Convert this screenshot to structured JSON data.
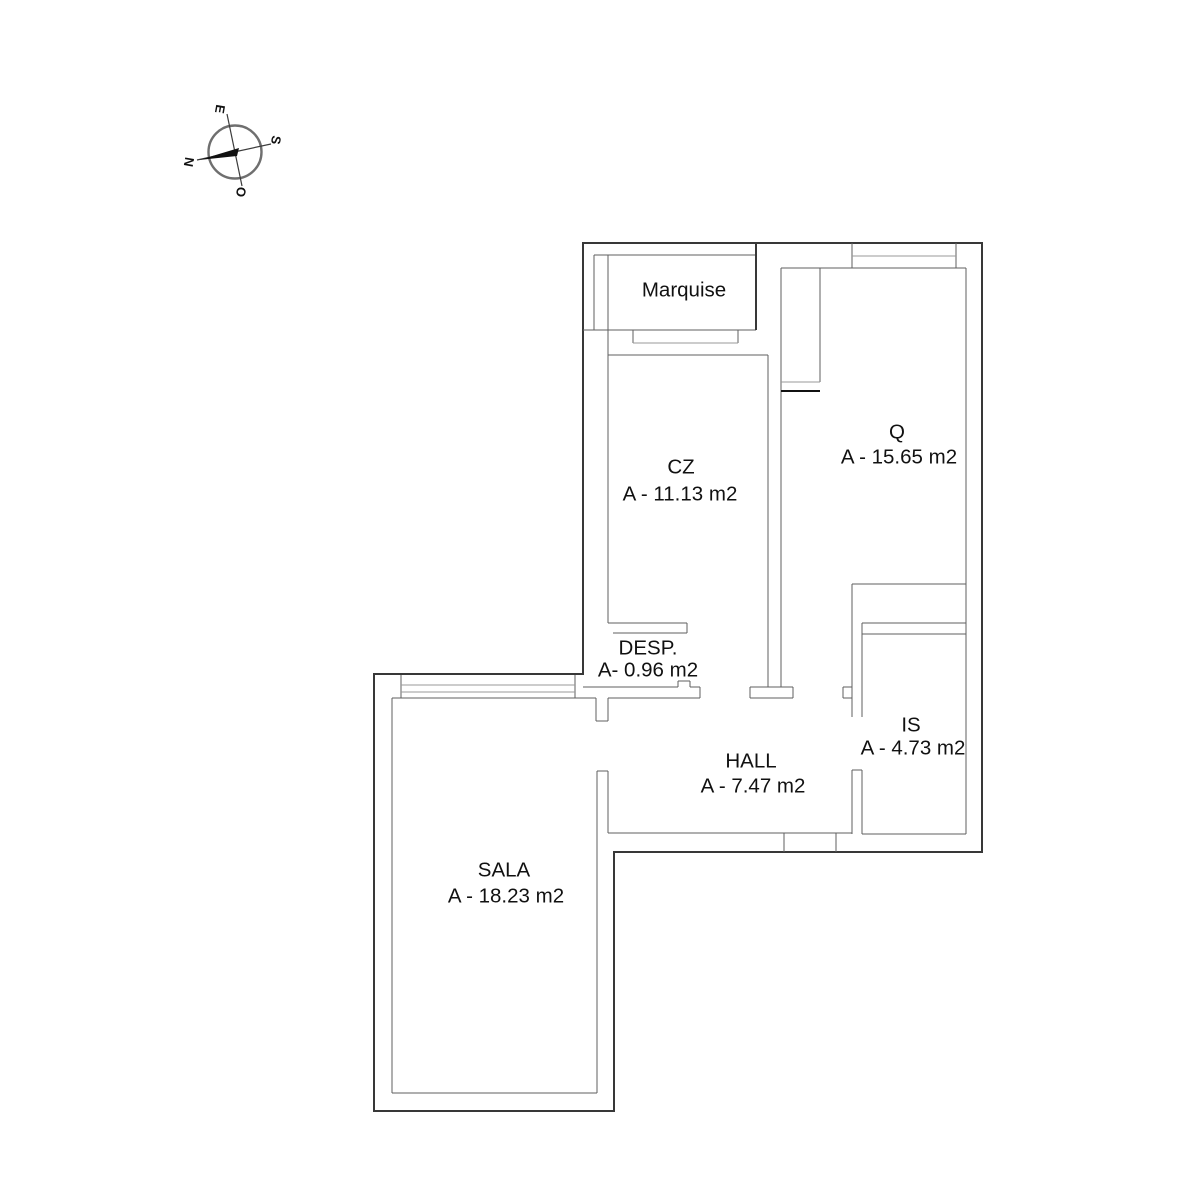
{
  "document": {
    "type": "floor-plan drawing",
    "background": "#ffffff"
  },
  "compass": {
    "north": "N",
    "south": "S",
    "east": "E",
    "west": "O"
  },
  "rooms": {
    "marquise": {
      "name": "Marquise",
      "area": ""
    },
    "cz": {
      "name": "CZ",
      "area": "A - 11.13 m2"
    },
    "q": {
      "name": "Q",
      "area": "A - 15.65 m2"
    },
    "desp": {
      "name": "DESP.",
      "area": "A- 0.96 m2"
    },
    "hall": {
      "name": "HALL",
      "area": "A - 7.47 m2"
    },
    "is": {
      "name": "IS",
      "area": "A - 4.73 m2"
    },
    "sala": {
      "name": "SALA",
      "area": "A - 18.23 m2"
    }
  },
  "colors": {
    "wall_outer": "#383838",
    "wall_inner": "#5f5f5f",
    "wall_light": "#9a9a9a",
    "wall_dark": "#111111",
    "text": "#111111",
    "background": "#ffffff"
  }
}
